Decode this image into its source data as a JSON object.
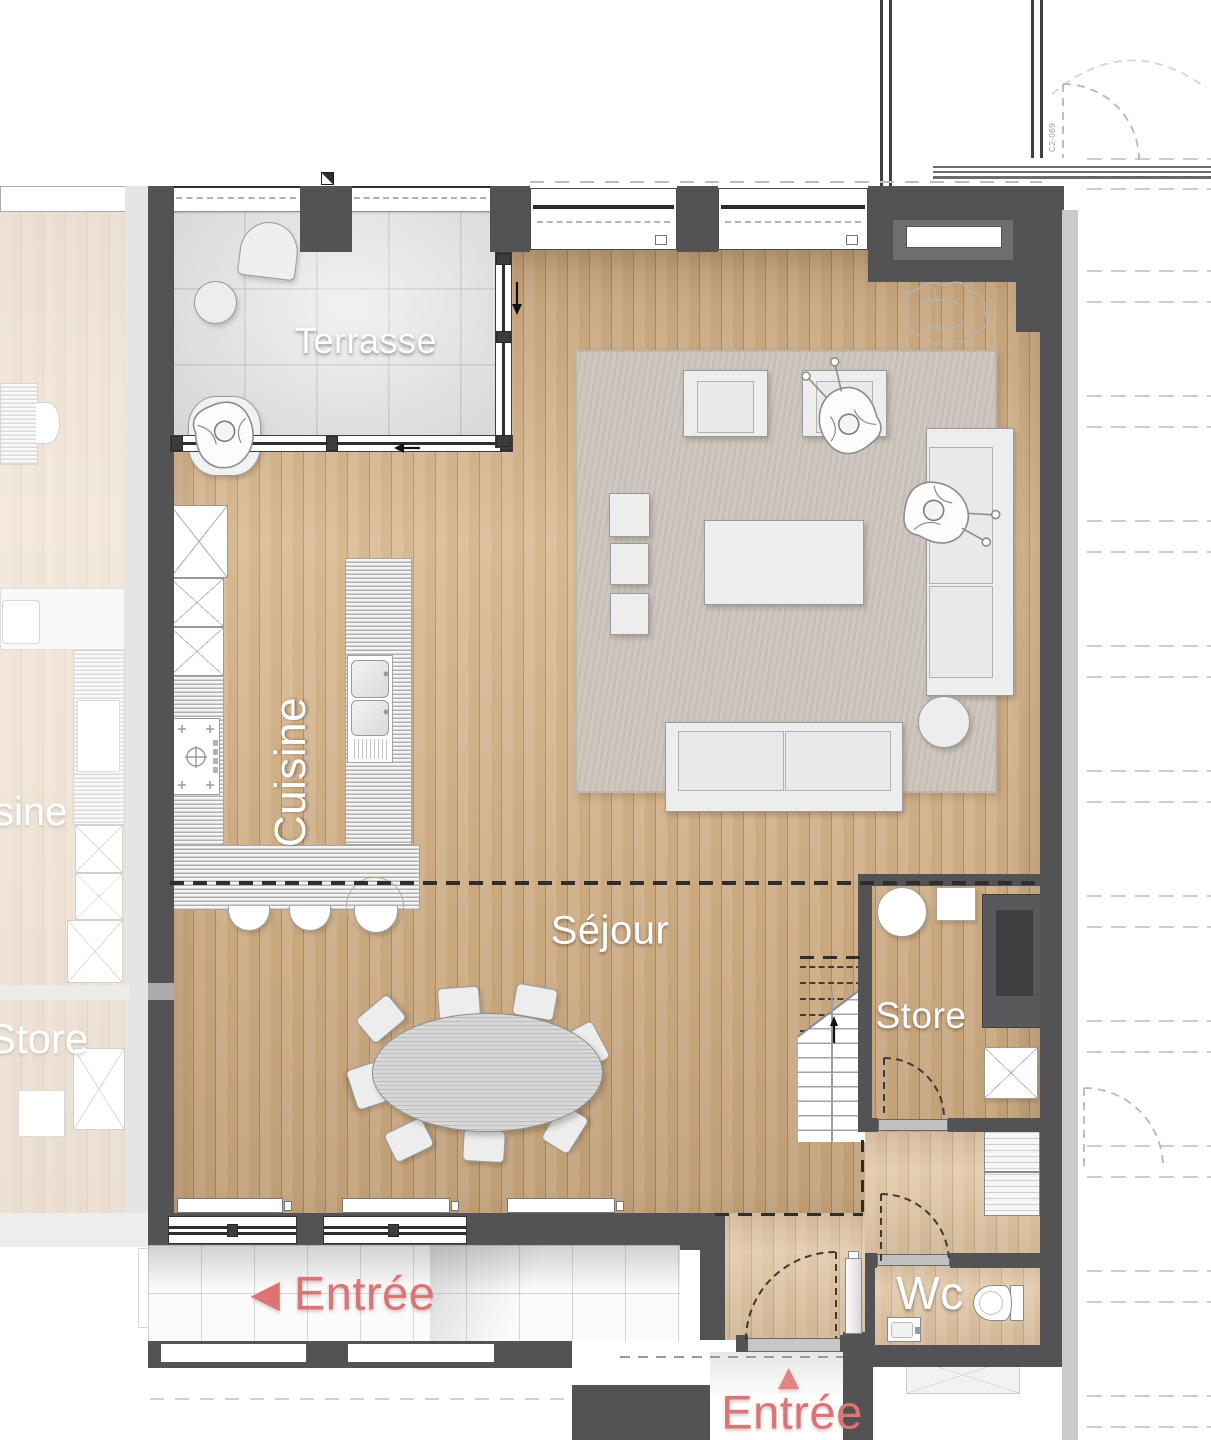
{
  "rooms": {
    "terrasse": {
      "label": "Terrasse"
    },
    "cuisine": {
      "label": "Cuisine"
    },
    "sejour": {
      "label": "Séjour"
    },
    "store": {
      "label": "Store"
    },
    "wc": {
      "label": "Wc"
    }
  },
  "entrances": {
    "corridor": {
      "label": "Entrée",
      "arrow": "◀"
    },
    "main": {
      "label": "Entrée",
      "arrow": "▲"
    }
  },
  "neighbor_unit": {
    "cuisine_label_partial": "sine",
    "store_label": "Store"
  },
  "annotations": {
    "door_code": "C2-069"
  },
  "colors": {
    "wall": "#535355",
    "wood_floor": "#d1ae83",
    "terrace_tile": "#e2e2e1",
    "rug": "#ccc5bc",
    "furniture": "#ededed",
    "counter": "#dfdfdf",
    "accent_red": "#db7474"
  }
}
